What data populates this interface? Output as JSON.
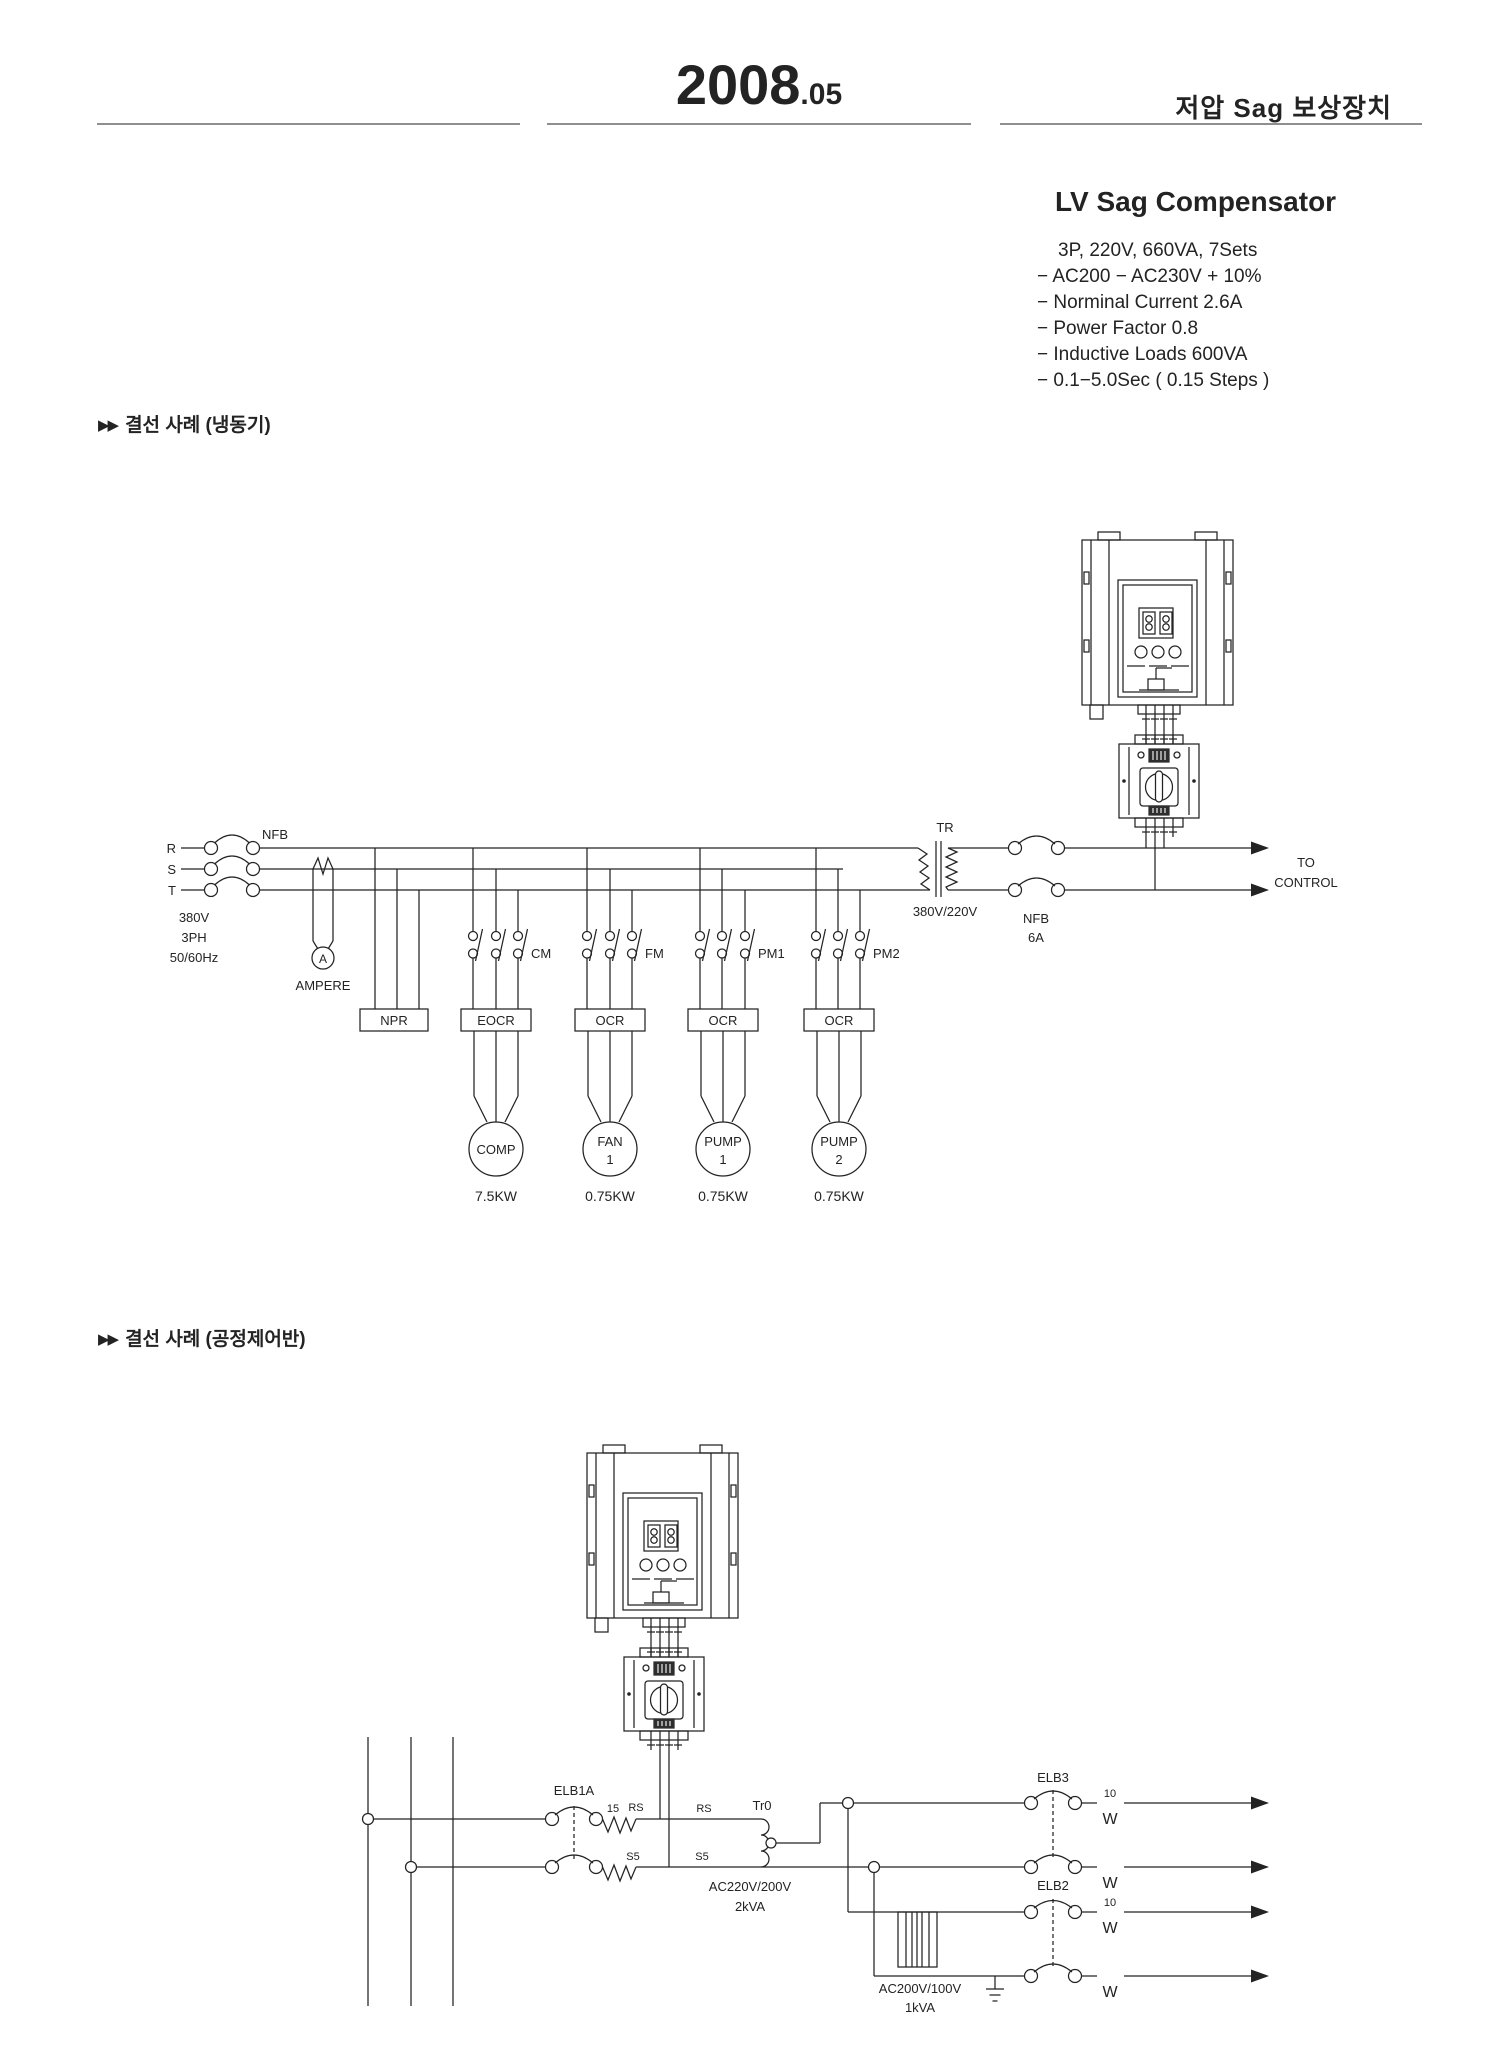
{
  "colors": {
    "paper": "#ffffff",
    "ink": "#232323",
    "rule": "#8f8f8f"
  },
  "header": {
    "year": "2008",
    "month": ".05",
    "doc_title_ko": "저압 Sag 보상장치"
  },
  "product": {
    "title": "LV Sag Compensator",
    "specs": [
      "3P, 220V, 660VA, 7Sets",
      "− AC200 − AC230V + 10%",
      "− Norminal Current 2.6A",
      "− Power Factor 0.8",
      "− Inductive Loads 600VA",
      "− 0.1−5.0Sec ( 0.15 Steps )"
    ]
  },
  "sections": {
    "s1_marker": "▶▶",
    "s1_title": "결선 사례 (냉동기)",
    "s2_marker": "▶▶",
    "s2_title": "결선 사례 (공정제어반)"
  },
  "d1": {
    "r": "R",
    "s": "S",
    "t": "T",
    "nfb": "NFB",
    "src1": "380V",
    "src2": "3PH",
    "src3": "50/60Hz",
    "a": "A",
    "ampere": "AMPERE",
    "npr": "NPR",
    "eocr": "EOCR",
    "ocr": "OCR",
    "cm": "CM",
    "fm": "FM",
    "pm1": "PM1",
    "pm2": "PM2",
    "tr": "TR",
    "ratio": "380V/220V",
    "nfb6_1": "NFB",
    "nfb6_2": "6A",
    "to1": "TO",
    "to2": "CONTROL",
    "m1l1": "COMP",
    "m1kw": "7.5KW",
    "m2l1": "FAN",
    "m2l2": "1",
    "m2kw": "0.75KW",
    "m3l1": "PUMP",
    "m3l2": "1",
    "m3kw": "0.75KW",
    "m4l1": "PUMP",
    "m4l2": "2",
    "m4kw": "0.75KW"
  },
  "d2": {
    "elb1a": "ELB1A",
    "n15": "15",
    "rs": "RS",
    "s5": "S5",
    "tr0": "Tr0",
    "rat1": "AC220V/200V",
    "rat2": "2kVA",
    "elb3": "ELB3",
    "elb2": "ELB2",
    "n10": "10",
    "w": "W",
    "pt1": "AC200V/100V",
    "pt2": "1kVA"
  }
}
